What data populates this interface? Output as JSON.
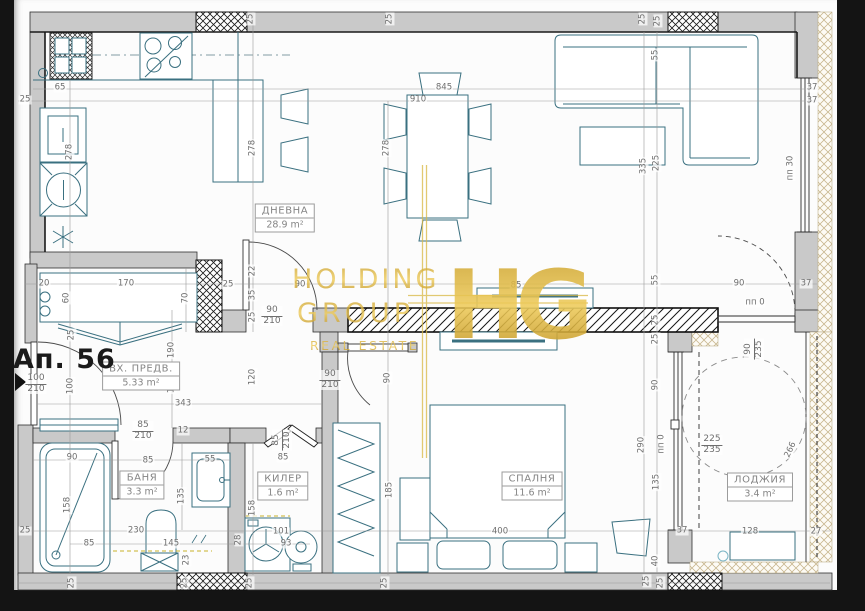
{
  "plan": {
    "apartment_label": "Ап. 56",
    "watermark": {
      "line1": "HOLDING",
      "line2": "GROUP",
      "line3": "REAL ESTATE",
      "monogram": "HG",
      "gold_dark": "#b98a16",
      "gold_light": "#eecb5a"
    },
    "rooms": [
      {
        "name": "ДНЕВНА",
        "area": "28.9 m²",
        "x": 285,
        "y": 218
      },
      {
        "name": "ВХ. ПРЕДВ.",
        "area": "5.33 m²",
        "x": 141,
        "y": 376
      },
      {
        "name": "БАНЯ",
        "area": "3.3 m²",
        "x": 142,
        "y": 485
      },
      {
        "name": "КИЛЕР",
        "area": "1.6 m²",
        "x": 283,
        "y": 486
      },
      {
        "name": "СПАЛНЯ",
        "area": "11.6 m²",
        "x": 532,
        "y": 486
      },
      {
        "name": "ЛОДЖИЯ",
        "area": "3.4 m²",
        "x": 760,
        "y": 487
      }
    ],
    "door_markers": [
      {
        "w": "100",
        "h": "210",
        "x": 36,
        "y": 384,
        "rot": 0
      },
      {
        "w": "90",
        "h": "210",
        "x": 272,
        "y": 316,
        "rot": 0
      },
      {
        "w": "90",
        "h": "210",
        "x": 330,
        "y": 380,
        "rot": 0
      },
      {
        "w": "85",
        "h": "210",
        "x": 143,
        "y": 431,
        "rot": 0
      },
      {
        "w": "85",
        "h": "210",
        "x": 282,
        "y": 440,
        "rot": 90
      },
      {
        "w": "90",
        "h": "235",
        "x": 754,
        "y": 349,
        "rot": 90
      },
      {
        "w": "225",
        "h": "235",
        "x": 712,
        "y": 445,
        "rot": 0
      }
    ],
    "dimensions": [
      {
        "t": "25",
        "x": 251,
        "y": 19,
        "r": 90
      },
      {
        "t": "25",
        "x": 390,
        "y": 19,
        "r": 90
      },
      {
        "t": "25",
        "x": 643,
        "y": 19,
        "r": 90
      },
      {
        "t": "25",
        "x": 658,
        "y": 21,
        "r": 90
      },
      {
        "t": "65",
        "x": 60,
        "y": 88,
        "r": 0
      },
      {
        "t": "845",
        "x": 444,
        "y": 88,
        "r": 0
      },
      {
        "t": "910",
        "x": 418,
        "y": 100,
        "r": 0
      },
      {
        "t": "37",
        "x": 812,
        "y": 88,
        "r": 0
      },
      {
        "t": "37",
        "x": 812,
        "y": 101,
        "r": 0
      },
      {
        "t": "25",
        "x": 25,
        "y": 100,
        "r": 0
      },
      {
        "t": "278",
        "x": 70,
        "y": 152,
        "r": 90
      },
      {
        "t": "278",
        "x": 253,
        "y": 148,
        "r": 90
      },
      {
        "t": "278",
        "x": 387,
        "y": 148,
        "r": 90
      },
      {
        "t": "335",
        "x": 644,
        "y": 166,
        "r": 90
      },
      {
        "t": "225",
        "x": 657,
        "y": 163,
        "r": 90
      },
      {
        "t": "55",
        "x": 656,
        "y": 55,
        "r": 90
      },
      {
        "t": "пп 30",
        "x": 791,
        "y": 168,
        "r": 90
      },
      {
        "t": "25",
        "x": 228,
        "y": 285,
        "r": 0
      },
      {
        "t": "90",
        "x": 300,
        "y": 285,
        "r": 0
      },
      {
        "t": "85",
        "x": 516,
        "y": 286,
        "r": 0
      },
      {
        "t": "22",
        "x": 253,
        "y": 271,
        "r": 90
      },
      {
        "t": "35",
        "x": 253,
        "y": 295,
        "r": 90
      },
      {
        "t": "25",
        "x": 253,
        "y": 317,
        "r": 90
      },
      {
        "t": "70",
        "x": 186,
        "y": 298,
        "r": 90
      },
      {
        "t": "55",
        "x": 656,
        "y": 280,
        "r": 90
      },
      {
        "t": "25",
        "x": 656,
        "y": 320,
        "r": 90
      },
      {
        "t": "25",
        "x": 656,
        "y": 339,
        "r": 90
      },
      {
        "t": "20",
        "x": 44,
        "y": 284,
        "r": 0
      },
      {
        "t": "170",
        "x": 126,
        "y": 284,
        "r": 0
      },
      {
        "t": "60",
        "x": 67,
        "y": 298,
        "r": 90
      },
      {
        "t": "25",
        "x": 72,
        "y": 335,
        "r": 90
      },
      {
        "t": "190",
        "x": 172,
        "y": 350,
        "r": 90
      },
      {
        "t": "120",
        "x": 172,
        "y": 385,
        "r": 90
      },
      {
        "t": "120",
        "x": 253,
        "y": 377,
        "r": 90
      },
      {
        "t": "100",
        "x": 71,
        "y": 386,
        "r": 90
      },
      {
        "t": "343",
        "x": 183,
        "y": 404,
        "r": 0
      },
      {
        "t": "90",
        "x": 388,
        "y": 378,
        "r": 90
      },
      {
        "t": "12",
        "x": 183,
        "y": 431,
        "r": 0
      },
      {
        "t": "90",
        "x": 72,
        "y": 458,
        "r": 0
      },
      {
        "t": "85",
        "x": 148,
        "y": 461,
        "r": 0
      },
      {
        "t": "55",
        "x": 210,
        "y": 460,
        "r": 0
      },
      {
        "t": "158",
        "x": 68,
        "y": 505,
        "r": 90
      },
      {
        "t": "135",
        "x": 182,
        "y": 496,
        "r": 90
      },
      {
        "t": "25",
        "x": 25,
        "y": 531,
        "r": 0
      },
      {
        "t": "230",
        "x": 136,
        "y": 531,
        "r": 0
      },
      {
        "t": "85",
        "x": 89,
        "y": 544,
        "r": 0
      },
      {
        "t": "145",
        "x": 171,
        "y": 544,
        "r": 0
      },
      {
        "t": "23",
        "x": 187,
        "y": 560,
        "r": 90
      },
      {
        "t": "28",
        "x": 239,
        "y": 540,
        "r": 90
      },
      {
        "t": "101",
        "x": 281,
        "y": 532,
        "r": 0
      },
      {
        "t": "93",
        "x": 286,
        "y": 544,
        "r": 0
      },
      {
        "t": "85",
        "x": 283,
        "y": 458,
        "r": 0
      },
      {
        "t": "158",
        "x": 253,
        "y": 508,
        "r": 90
      },
      {
        "t": "185",
        "x": 390,
        "y": 490,
        "r": 90
      },
      {
        "t": "25",
        "x": 72,
        "y": 583,
        "r": 90
      },
      {
        "t": "25",
        "x": 185,
        "y": 583,
        "r": 90
      },
      {
        "t": "25",
        "x": 250,
        "y": 583,
        "r": 90
      },
      {
        "t": "25",
        "x": 385,
        "y": 583,
        "r": 90
      },
      {
        "t": "25",
        "x": 647,
        "y": 581,
        "r": 90
      },
      {
        "t": "25",
        "x": 661,
        "y": 583,
        "r": 90
      },
      {
        "t": "400",
        "x": 500,
        "y": 532,
        "r": 0
      },
      {
        "t": "40",
        "x": 656,
        "y": 561,
        "r": 90
      },
      {
        "t": "290",
        "x": 642,
        "y": 445,
        "r": 90
      },
      {
        "t": "90",
        "x": 656,
        "y": 385,
        "r": 90
      },
      {
        "t": "пп 0",
        "x": 662,
        "y": 444,
        "r": 90
      },
      {
        "t": "135",
        "x": 657,
        "y": 482,
        "r": 90
      },
      {
        "t": "90",
        "x": 739,
        "y": 284,
        "r": 0
      },
      {
        "t": "пп 0",
        "x": 755,
        "y": 303,
        "r": 0
      },
      {
        "t": "37",
        "x": 806,
        "y": 284,
        "r": 0
      },
      {
        "t": "266",
        "x": 791,
        "y": 450,
        "r": 65
      },
      {
        "t": "128",
        "x": 750,
        "y": 532,
        "r": 0
      },
      {
        "t": "37",
        "x": 682,
        "y": 531,
        "r": 0
      },
      {
        "t": "27",
        "x": 816,
        "y": 532,
        "r": 0
      }
    ]
  }
}
